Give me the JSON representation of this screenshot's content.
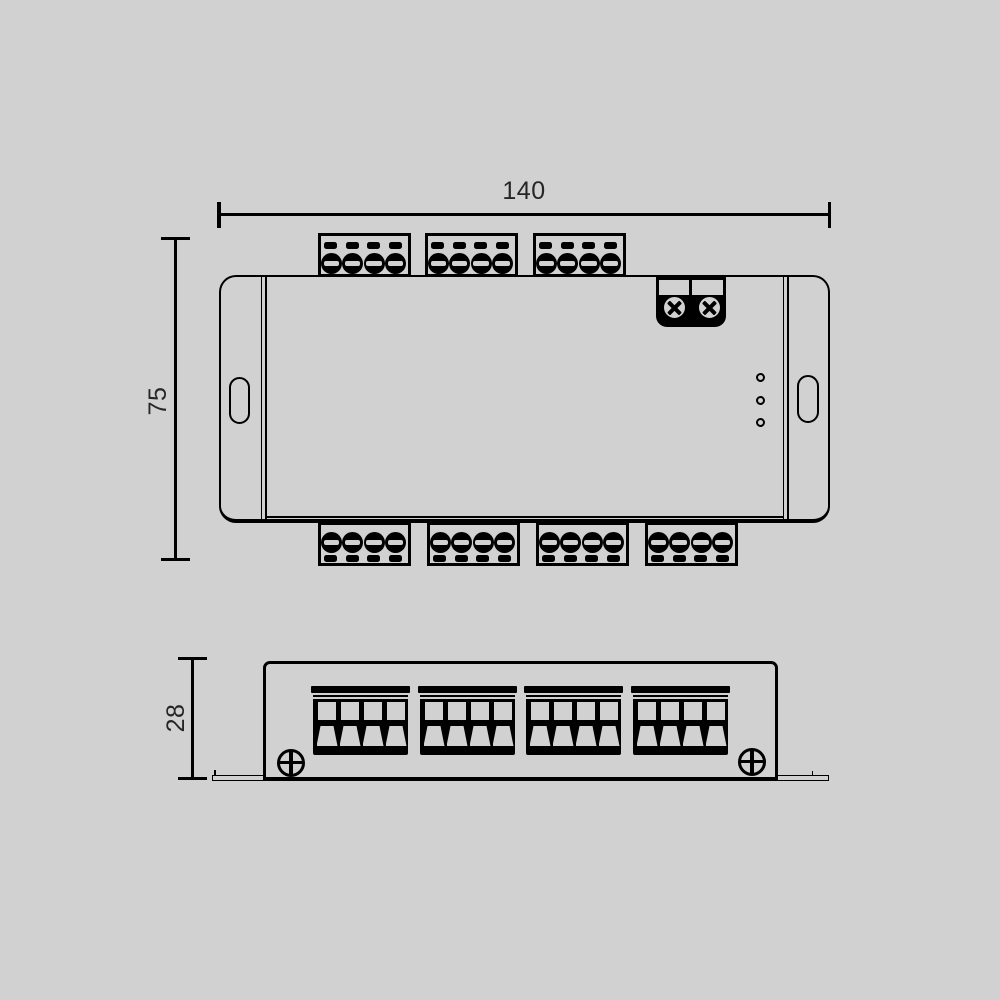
{
  "canvas": {
    "background": "#d1d1d1",
    "line_color": "#000000",
    "text_color": "#262626"
  },
  "dimensions": {
    "width": {
      "label": "140"
    },
    "height": {
      "label": "75"
    },
    "depth": {
      "label": "28"
    }
  },
  "top_view": {
    "terminal_blocks_top": 3,
    "terminal_blocks_bottom": 4,
    "poles_per_block": 4,
    "power_screws": 2,
    "led_indicators": 3,
    "mounting_slots": 2
  },
  "front_view": {
    "terminal_blocks": 4,
    "poles_per_block": 4,
    "mounting_screws": 2
  }
}
